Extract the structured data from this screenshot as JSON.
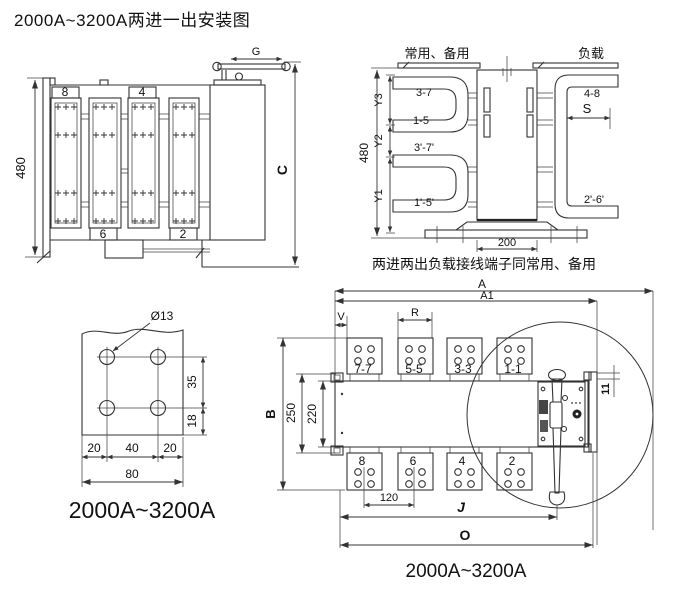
{
  "title": "2000A~3200A两进一出安装图",
  "colors": {
    "line": "#333333",
    "fill_light": "#e3e3e3",
    "fill_busbar": "#c6cac9"
  },
  "side_view": {
    "dim_height": "480",
    "dim_depth": "C",
    "dim_handle": "G",
    "terminal_top_1": "8",
    "terminal_top_2": "4",
    "terminal_bottom_1": "6",
    "terminal_bottom_2": "2"
  },
  "top_view": {
    "label_supply": "常用、备用",
    "label_load": "负载",
    "dim_height": "480",
    "dim_y3": "Y3",
    "dim_y2": "Y2",
    "dim_y1": "Y1",
    "dim_width": "200",
    "dim_s": "S",
    "term_upper_top": "3-7",
    "term_upper_bottom": "1-5",
    "term_lower_top": "3'-7'",
    "term_lower_bottom": "1'-5'",
    "term_right_top": "4-8",
    "term_right_bottom": "2'-6'",
    "note": "两进两出负载接线端子同常用、备用"
  },
  "busbar_detail": {
    "hole_label": "Ø13",
    "dim_35": "35",
    "dim_18": "18",
    "dim_20a": "20",
    "dim_40": "40",
    "dim_20b": "20",
    "dim_80": "80",
    "caption": "2000A~3200A"
  },
  "front_view": {
    "dim_a": "A",
    "dim_a1": "A1",
    "dim_v": "V",
    "dim_r": "R",
    "dim_b": "B",
    "dim_250": "250",
    "dim_220": "220",
    "dim_11": "11",
    "dim_120": "120",
    "dim_j": "J",
    "dim_o": "O",
    "top_terminals": [
      "7-7",
      "5-5",
      "3-3",
      "1-1"
    ],
    "bottom_terminals": [
      "8",
      "6",
      "4",
      "2"
    ],
    "caption": "2000A~3200A"
  }
}
